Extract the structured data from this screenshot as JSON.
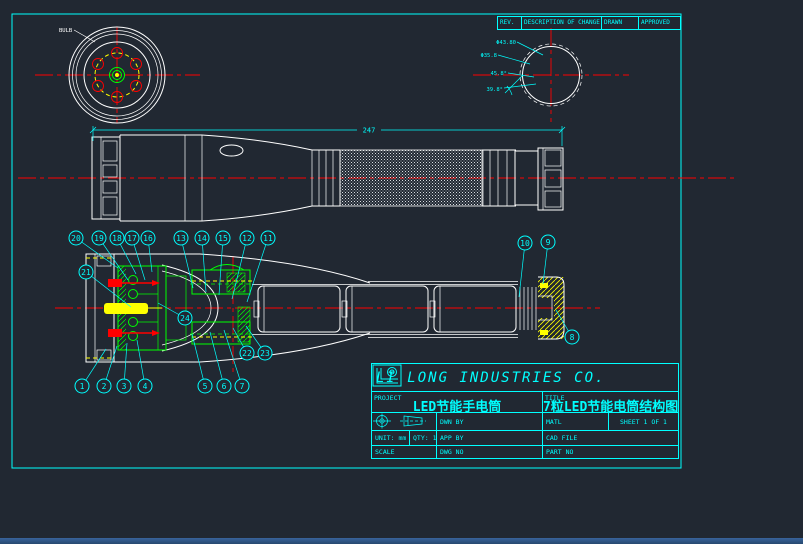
{
  "colors": {
    "background": "#212832",
    "cyan": "#00ffff",
    "white": "#ffffff",
    "red": "#ff0000",
    "green": "#00ff00",
    "yellow": "#ffff00"
  },
  "revision_table": {
    "headers": [
      "REV.",
      "DESCRIPTION OF CHANGE",
      "DRAWN",
      "APPROVED"
    ]
  },
  "front_view": {
    "label": "BULB"
  },
  "side_view": {
    "dimension": "247"
  },
  "detail_view": {
    "dims": [
      "Φ43.80",
      "Φ35.8",
      "45.8°",
      "39.8°"
    ]
  },
  "title_block": {
    "company": "LI LONG INDUSTRIES CO.",
    "project_label": "PROJECT",
    "project_value": "LED节能手电筒",
    "title_label": "TITLE",
    "title_value": "7粒LED节能电筒结构图",
    "dwn_by": "DWN BY",
    "app_by": "APP BY",
    "dwg_no": "DWG NO",
    "matl": "MATL",
    "cad_file": "CAD FILE",
    "part_no": "PART NO",
    "sheet_text": "SHEET 1 OF 1",
    "unit_label": "UNIT: mm",
    "qty_label": "QTY: 1",
    "scale_label": "SCALE"
  },
  "balloons": [
    {
      "n": "1",
      "x": 82,
      "y": 386,
      "tx": 106,
      "ty": 349
    },
    {
      "n": "2",
      "x": 104,
      "y": 386,
      "tx": 117,
      "ty": 346
    },
    {
      "n": "3",
      "x": 124,
      "y": 386,
      "tx": 127,
      "ty": 343
    },
    {
      "n": "4",
      "x": 145,
      "y": 386,
      "tx": 137,
      "ty": 340
    },
    {
      "n": "5",
      "x": 205,
      "y": 386,
      "tx": 192,
      "ty": 334
    },
    {
      "n": "6",
      "x": 224,
      "y": 386,
      "tx": 210,
      "ty": 332
    },
    {
      "n": "7",
      "x": 242,
      "y": 386,
      "tx": 224,
      "ty": 330
    },
    {
      "n": "8",
      "x": 572,
      "y": 337,
      "tx": 556,
      "ty": 310
    },
    {
      "n": "9",
      "x": 548,
      "y": 242,
      "tx": 543,
      "ty": 284
    },
    {
      "n": "10",
      "x": 525,
      "y": 243,
      "tx": 519,
      "ty": 297
    },
    {
      "n": "11",
      "x": 268,
      "y": 238,
      "tx": 247,
      "ty": 302
    },
    {
      "n": "12",
      "x": 247,
      "y": 238,
      "tx": 232,
      "ty": 299
    },
    {
      "n": "13",
      "x": 181,
      "y": 238,
      "tx": 193,
      "ty": 288
    },
    {
      "n": "14",
      "x": 202,
      "y": 238,
      "tx": 206,
      "ty": 292
    },
    {
      "n": "15",
      "x": 223,
      "y": 238,
      "tx": 219,
      "ty": 295
    },
    {
      "n": "16",
      "x": 148,
      "y": 238,
      "tx": 152,
      "ty": 272
    },
    {
      "n": "17",
      "x": 132,
      "y": 238,
      "tx": 145,
      "ty": 280
    },
    {
      "n": "18",
      "x": 117,
      "y": 238,
      "tx": 136,
      "ty": 274
    },
    {
      "n": "19",
      "x": 99,
      "y": 238,
      "tx": 128,
      "ty": 280
    },
    {
      "n": "20",
      "x": 76,
      "y": 238,
      "tx": 118,
      "ty": 268
    },
    {
      "n": "21",
      "x": 86,
      "y": 272,
      "tx": 131,
      "ty": 307
    },
    {
      "n": "22",
      "x": 247,
      "y": 353,
      "tx": 233,
      "ty": 328
    },
    {
      "n": "23",
      "x": 265,
      "y": 353,
      "tx": 246,
      "ty": 326
    },
    {
      "n": "24",
      "x": 185,
      "y": 318,
      "tx": 158,
      "ty": 303
    }
  ]
}
